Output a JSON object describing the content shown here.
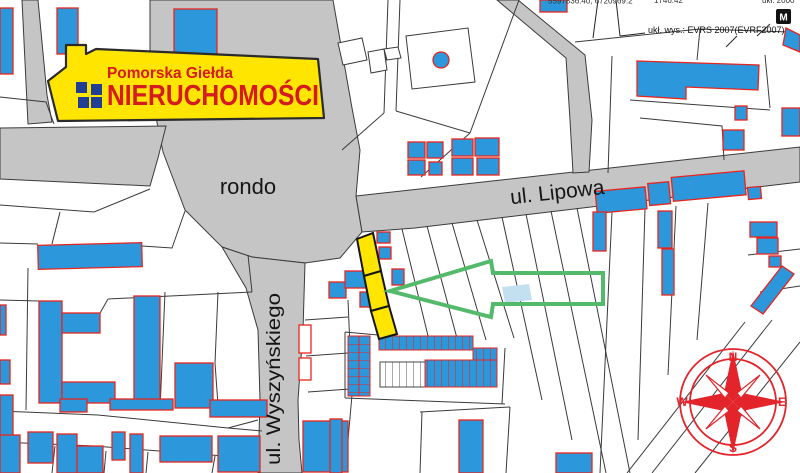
{
  "logo": {
    "top_line": "Pomorska Giełda",
    "main_line": "NIERUCHOMOŚCI"
  },
  "labels": {
    "rondo": "rondo",
    "lipowa": "ul. Lipowa",
    "wyszynskiego": "ul. Wyszyńskiego"
  },
  "annotations": {
    "datum_note": "ukł. wys.: EVRS 2007(EVRF2007)",
    "map_marker": "M",
    "clipped_top_left": "5597836.40; 6720969.2",
    "clipped_top_mid": "1746.42",
    "clipped_top_right": "ukł. 2000"
  },
  "compass": {
    "north": "N",
    "east": "E",
    "south": "S",
    "west": "W"
  },
  "colors": {
    "road_gray": "#C5C5C5",
    "parcel_line": "#3A3A3A",
    "building_blue": "#2D97DB",
    "building_outline_red": "#E8251D",
    "highlight_yellow": "#FFE500",
    "arrow_green": "#55B96B",
    "compass_red": "#E3242B",
    "logo_red": "#D71920",
    "logo_window_navy": "#1F3E94",
    "water_blue": "#C2E0F0"
  }
}
